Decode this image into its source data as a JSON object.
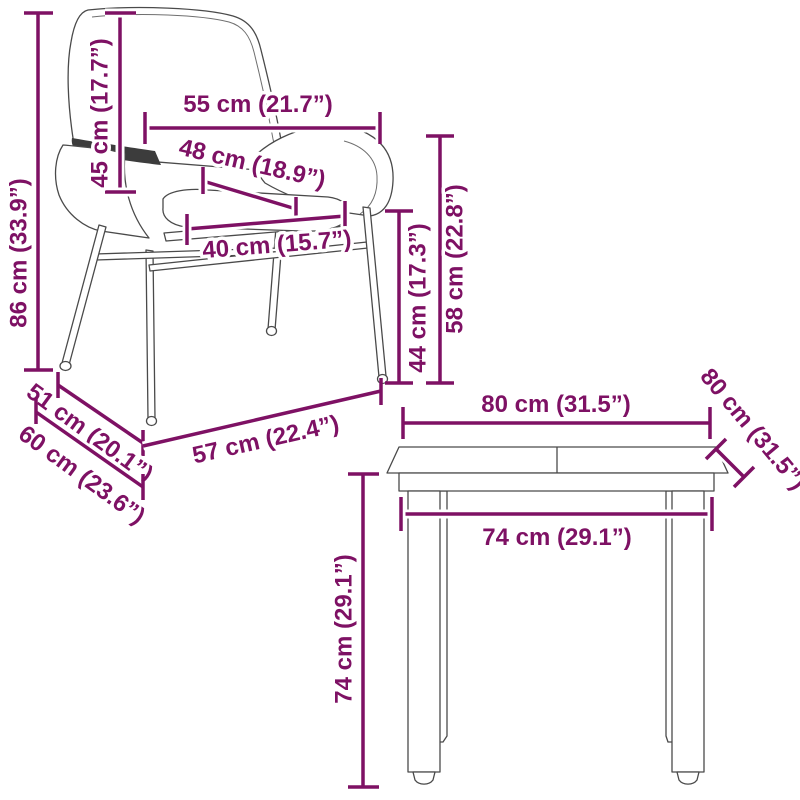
{
  "diagram_type": "furniture dimension drawing",
  "colors": {
    "dimension_accent": "#7E1164",
    "artwork_line": "#4a4a4a",
    "background": "#ffffff",
    "armrest_shadow": "#3c3c3c"
  },
  "chair": {
    "name": "rattan garden chair illustration",
    "dimensions": {
      "total_height": "86 cm (33.9”)",
      "backrest_height": "45 cm (17.7”)",
      "top_width": "55 cm (21.7”)",
      "seat_depth": "48 cm (18.9”)",
      "seat_width": "40 cm (15.7”)",
      "seat_height": "44 cm (17.3”)",
      "armrest_height": "58 cm (22.8”)",
      "base_depth_inner": "51 cm (20.1”)",
      "base_depth_outer": "60 cm (23.6”)",
      "base_width": "57 cm (22.4”)"
    }
  },
  "table": {
    "name": "garden table illustration",
    "dimensions": {
      "top_width": "80 cm (31.5”)",
      "top_depth": "80 cm (31.5”)",
      "leg_span": "74 cm (29.1”)",
      "height": "74 cm (29.1”)"
    }
  }
}
